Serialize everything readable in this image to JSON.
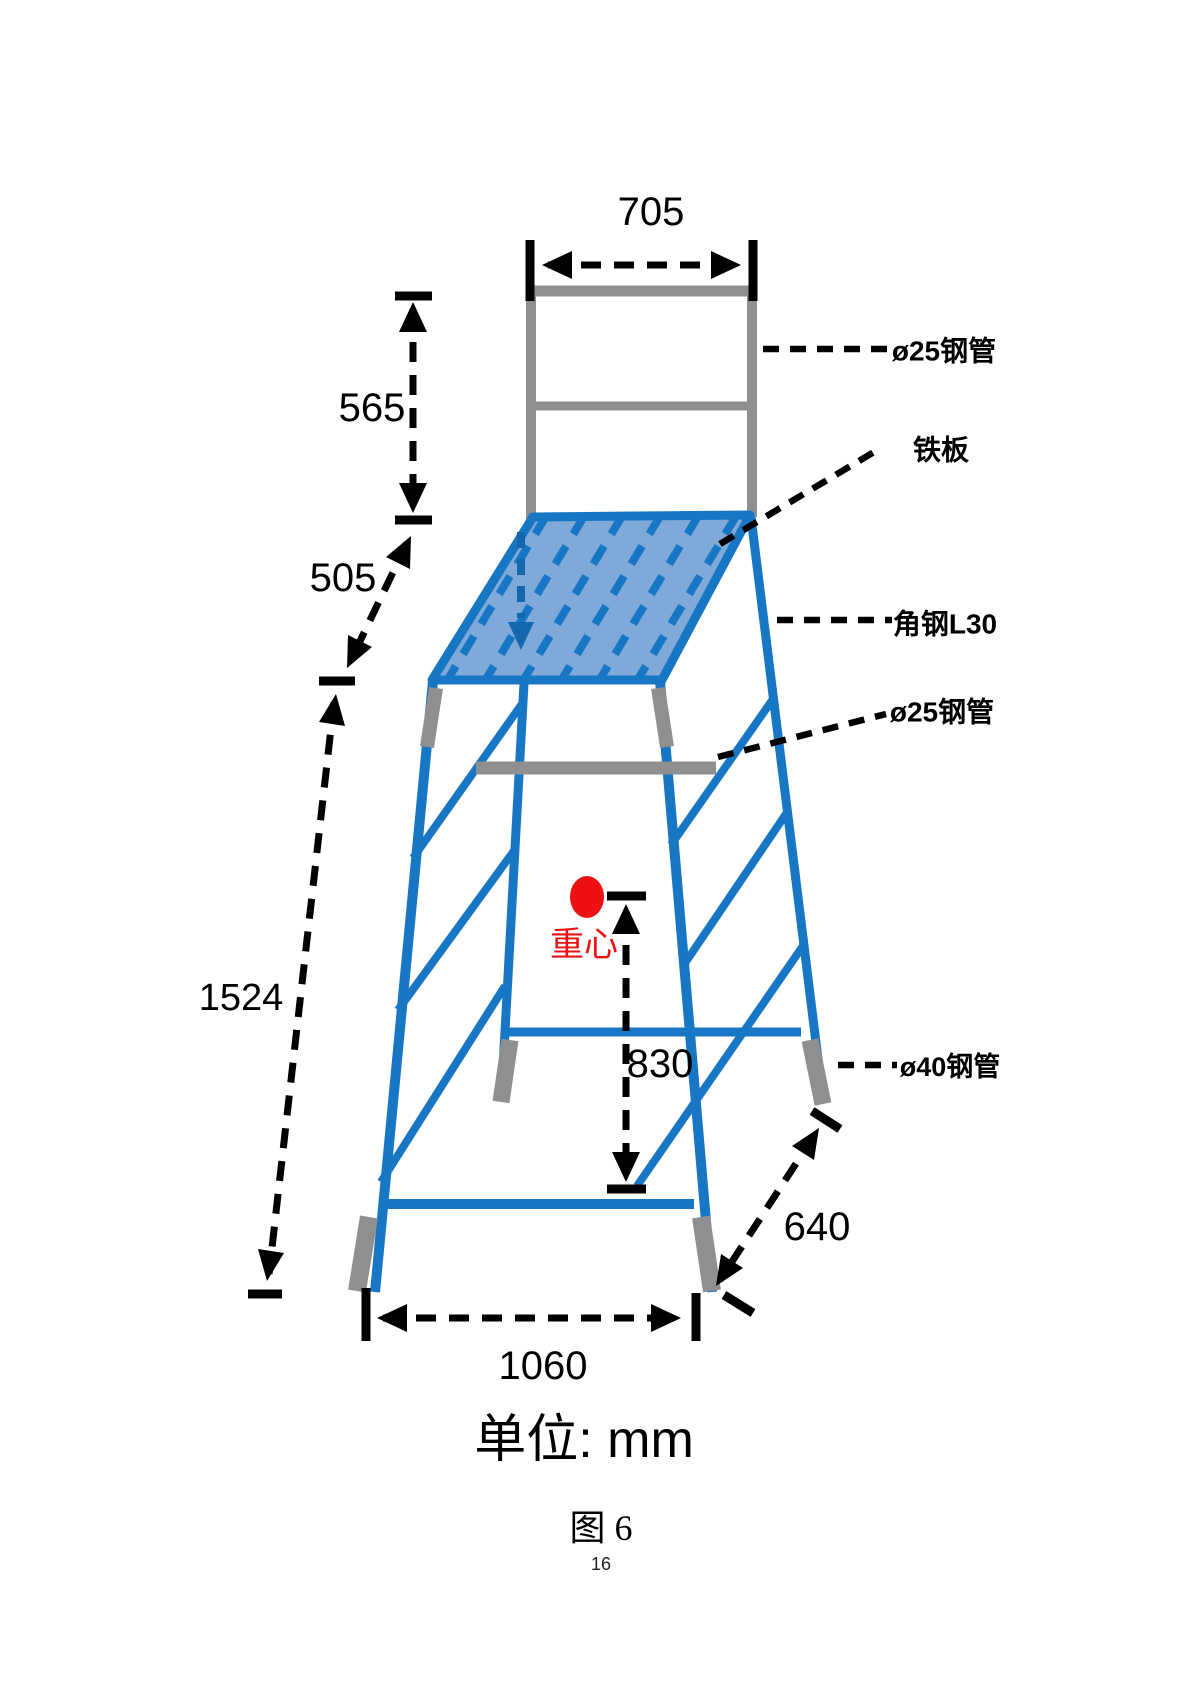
{
  "figure": {
    "unit_label": "单位: mm",
    "caption": "图 6",
    "page_number": "16"
  },
  "dimensions": {
    "top_width": "705",
    "backrest_height": "565",
    "platform_drop": "505",
    "overall_height": "1524",
    "cog_height": "830",
    "base_width": "1060",
    "base_depth": "640"
  },
  "annotations": {
    "pipe25_top": "ø25钢管",
    "plate": "铁板",
    "angle_steel": "角钢L30",
    "pipe25_mid": "ø25钢管",
    "pipe40": "ø40钢管",
    "center_of_gravity": "重心"
  },
  "colors": {
    "structure_blue": "#1877c5",
    "platform_fill": "#7ea9d8",
    "steel_gray": "#8f8f8f",
    "cog_red": "#ee1111",
    "dimension_black": "#000000"
  }
}
